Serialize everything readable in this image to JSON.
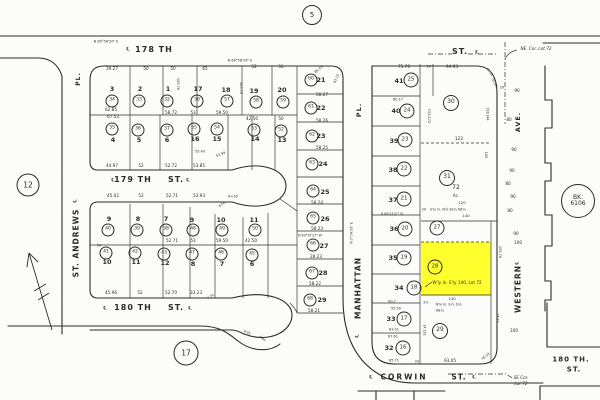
{
  "page": {
    "background": "#fcfcfa",
    "ink": "#2b2b2b",
    "highlight_color": "#ffff2e"
  },
  "highlight": {
    "parcel_circle": "28",
    "x": 421,
    "y": 242,
    "w": 70,
    "h": 53
  },
  "markers": [
    {
      "t": "5",
      "x": 312,
      "y": 15,
      "d": 18,
      "fs": 7
    },
    {
      "t": "12",
      "x": 28,
      "y": 185,
      "d": 21,
      "fs": 7.5
    },
    {
      "t": "17",
      "x": 186,
      "y": 353,
      "d": 23,
      "fs": 7.5
    },
    {
      "t": "BK.\n6106",
      "x": 578,
      "y": 201,
      "d": 32,
      "fs": 6
    }
  ],
  "streets": [
    {
      "t": "178 TH",
      "x": 154,
      "y": 50,
      "fs": 8,
      "ls": 1
    },
    {
      "t": "ST.",
      "x": 460,
      "y": 52,
      "fs": 8
    },
    {
      "t": "179 TH",
      "x": 133,
      "y": 180,
      "fs": 8,
      "ls": 1
    },
    {
      "t": "ST.",
      "x": 176,
      "y": 180,
      "fs": 8
    },
    {
      "t": "180 TH",
      "x": 133,
      "y": 308,
      "fs": 8,
      "ls": 1
    },
    {
      "t": "ST.",
      "x": 176,
      "y": 308,
      "fs": 8
    },
    {
      "t": "CORWIN",
      "x": 404,
      "y": 377,
      "fs": 7.5,
      "ls": 2
    },
    {
      "t": "ST.",
      "x": 459,
      "y": 377,
      "fs": 7.5
    },
    {
      "t": "ST. ANDREWS",
      "x": 76,
      "y": 243,
      "fs": 7.5,
      "r": -90,
      "ls": 1
    },
    {
      "t": "PL.",
      "x": 79,
      "y": 79,
      "fs": 6,
      "r": -90
    },
    {
      "t": "MANHATTAN",
      "x": 358,
      "y": 288,
      "fs": 7.5,
      "r": -90,
      "ls": 1
    },
    {
      "t": "PL.",
      "x": 359,
      "y": 110,
      "fs": 6.5,
      "r": -90
    },
    {
      "t": "WESTERN",
      "x": 518,
      "y": 289,
      "fs": 7.5,
      "r": -90,
      "ls": 1
    },
    {
      "t": "AVE.",
      "x": 518,
      "y": 122,
      "fs": 6.5,
      "r": -90
    },
    {
      "t": "180 TH.",
      "x": 571,
      "y": 360,
      "fs": 7
    },
    {
      "t": "ST.",
      "x": 574,
      "y": 370,
      "fs": 7
    }
  ],
  "centerline_marks": [
    {
      "t": "℄",
      "x": 128,
      "y": 50
    },
    {
      "t": "℄",
      "x": 477,
      "y": 53
    },
    {
      "t": "℄",
      "x": 113,
      "y": 181
    },
    {
      "t": "℄",
      "x": 188,
      "y": 181
    },
    {
      "t": "℄",
      "x": 105,
      "y": 309
    },
    {
      "t": "℄",
      "x": 190,
      "y": 309
    },
    {
      "t": "℄",
      "x": 371,
      "y": 378
    },
    {
      "t": "℄",
      "x": 474,
      "y": 378
    },
    {
      "t": "℄",
      "x": 76,
      "y": 201,
      "r": -90
    },
    {
      "t": "℄",
      "x": 518,
      "y": 263,
      "r": -90
    },
    {
      "t": "℄",
      "x": 358,
      "y": 336,
      "r": -90
    }
  ],
  "notes": [
    {
      "t": "NE. Cor. Lot 72",
      "x": 536,
      "y": 49
    },
    {
      "t": "SE Cor.",
      "x": 521,
      "y": 378
    },
    {
      "t": "Lot 72",
      "x": 521,
      "y": 384
    }
  ],
  "lot_numbers": [
    {
      "t": "3",
      "x": 112,
      "y": 89
    },
    {
      "t": "2",
      "x": 140,
      "y": 89
    },
    {
      "t": "1",
      "x": 168,
      "y": 89
    },
    {
      "t": "17",
      "x": 198,
      "y": 89
    },
    {
      "t": "18",
      "x": 226,
      "y": 90
    },
    {
      "t": "19",
      "x": 254,
      "y": 91
    },
    {
      "t": "20",
      "x": 282,
      "y": 90
    },
    {
      "t": "21",
      "x": 321,
      "y": 80
    },
    {
      "t": "22",
      "x": 321,
      "y": 108
    },
    {
      "t": "23",
      "x": 321,
      "y": 136
    },
    {
      "t": "24",
      "x": 323,
      "y": 164
    },
    {
      "t": "25",
      "x": 325,
      "y": 192
    },
    {
      "t": "26",
      "x": 325,
      "y": 219
    },
    {
      "t": "27",
      "x": 324,
      "y": 246
    },
    {
      "t": "28",
      "x": 323,
      "y": 273
    },
    {
      "t": "29",
      "x": 322,
      "y": 300
    },
    {
      "t": "4",
      "x": 113,
      "y": 140
    },
    {
      "t": "5",
      "x": 139,
      "y": 140
    },
    {
      "t": "6",
      "x": 167,
      "y": 140
    },
    {
      "t": "16",
      "x": 195,
      "y": 139
    },
    {
      "t": "15",
      "x": 217,
      "y": 139
    },
    {
      "t": "14",
      "x": 255,
      "y": 139
    },
    {
      "t": "13",
      "x": 282,
      "y": 140
    },
    {
      "t": "9",
      "x": 109,
      "y": 219
    },
    {
      "t": "8",
      "x": 138,
      "y": 219
    },
    {
      "t": "7",
      "x": 166,
      "y": 219
    },
    {
      "t": "9",
      "x": 192,
      "y": 220
    },
    {
      "t": "10",
      "x": 221,
      "y": 220
    },
    {
      "t": "11",
      "x": 254,
      "y": 220
    },
    {
      "t": "10",
      "x": 107,
      "y": 262
    },
    {
      "t": "11",
      "x": 136,
      "y": 262
    },
    {
      "t": "12",
      "x": 165,
      "y": 263
    },
    {
      "t": "8",
      "x": 193,
      "y": 264
    },
    {
      "t": "7",
      "x": 222,
      "y": 264
    },
    {
      "t": "6",
      "x": 252,
      "y": 264
    },
    {
      "t": "41",
      "x": 399,
      "y": 81
    },
    {
      "t": "40",
      "x": 396,
      "y": 111
    },
    {
      "t": "39",
      "x": 394,
      "y": 141
    },
    {
      "t": "38",
      "x": 393,
      "y": 170
    },
    {
      "t": "37",
      "x": 393,
      "y": 200
    },
    {
      "t": "36",
      "x": 394,
      "y": 229
    },
    {
      "t": "35",
      "x": 393,
      "y": 258
    },
    {
      "t": "34",
      "x": 399,
      "y": 288
    },
    {
      "t": "33",
      "x": 391,
      "y": 319
    },
    {
      "t": "32",
      "x": 389,
      "y": 348
    }
  ],
  "lot_circles": [
    {
      "t": "34",
      "x": 112,
      "y": 101
    },
    {
      "t": "33",
      "x": 139,
      "y": 101
    },
    {
      "t": "32",
      "x": 167,
      "y": 101
    },
    {
      "t": "56",
      "x": 197,
      "y": 101
    },
    {
      "t": "57",
      "x": 227,
      "y": 101
    },
    {
      "t": "58",
      "x": 256,
      "y": 102
    },
    {
      "t": "59",
      "x": 283,
      "y": 102
    },
    {
      "t": "60",
      "x": 311,
      "y": 80
    },
    {
      "t": "61",
      "x": 311,
      "y": 108
    },
    {
      "t": "62",
      "x": 312,
      "y": 136
    },
    {
      "t": "63",
      "x": 312,
      "y": 164
    },
    {
      "t": "64",
      "x": 313,
      "y": 191
    },
    {
      "t": "65",
      "x": 313,
      "y": 218
    },
    {
      "t": "66",
      "x": 313,
      "y": 245
    },
    {
      "t": "67",
      "x": 312,
      "y": 273
    },
    {
      "t": "68",
      "x": 310,
      "y": 300
    },
    {
      "t": "35",
      "x": 112,
      "y": 129
    },
    {
      "t": "36",
      "x": 138,
      "y": 130
    },
    {
      "t": "37",
      "x": 167,
      "y": 130
    },
    {
      "t": "55",
      "x": 194,
      "y": 129
    },
    {
      "t": "54",
      "x": 217,
      "y": 129
    },
    {
      "t": "53",
      "x": 254,
      "y": 130
    },
    {
      "t": "52",
      "x": 281,
      "y": 131
    },
    {
      "t": "40",
      "x": 108,
      "y": 230
    },
    {
      "t": "39",
      "x": 137,
      "y": 230
    },
    {
      "t": "38",
      "x": 166,
      "y": 230
    },
    {
      "t": "48",
      "x": 193,
      "y": 230
    },
    {
      "t": "49",
      "x": 222,
      "y": 230
    },
    {
      "t": "50",
      "x": 255,
      "y": 230
    },
    {
      "t": "41",
      "x": 106,
      "y": 253
    },
    {
      "t": "42",
      "x": 135,
      "y": 253
    },
    {
      "t": "43",
      "x": 164,
      "y": 254
    },
    {
      "t": "47",
      "x": 192,
      "y": 254
    },
    {
      "t": "46",
      "x": 221,
      "y": 254
    },
    {
      "t": "45",
      "x": 252,
      "y": 255
    },
    {
      "t": "25",
      "x": 411,
      "y": 80,
      "d": 13
    },
    {
      "t": "24",
      "x": 407,
      "y": 111,
      "d": 13
    },
    {
      "t": "23",
      "x": 405,
      "y": 140,
      "d": 13
    },
    {
      "t": "22",
      "x": 404,
      "y": 169,
      "d": 13
    },
    {
      "t": "21",
      "x": 404,
      "y": 199,
      "d": 13
    },
    {
      "t": "20",
      "x": 405,
      "y": 229,
      "d": 13
    },
    {
      "t": "19",
      "x": 404,
      "y": 258,
      "d": 13
    },
    {
      "t": "18",
      "x": 414,
      "y": 288,
      "d": 13
    },
    {
      "t": "17",
      "x": 404,
      "y": 319,
      "d": 13
    },
    {
      "t": "16",
      "x": 403,
      "y": 348,
      "d": 13
    },
    {
      "t": "30",
      "x": 451,
      "y": 103,
      "d": 14
    },
    {
      "t": "31",
      "x": 447,
      "y": 178,
      "d": 14
    },
    {
      "t": "27",
      "x": 437,
      "y": 228,
      "d": 13
    },
    {
      "t": "28",
      "x": 435,
      "y": 267,
      "d": 13
    },
    {
      "t": "29",
      "x": 440,
      "y": 331,
      "d": 14
    }
  ],
  "dims": [
    {
      "t": "N 89°58'20\" E",
      "x": 106,
      "y": 42,
      "fs": 3.5
    },
    {
      "t": "N 89°58'20\" E",
      "x": 240,
      "y": 61,
      "fs": 3.5
    },
    {
      "t": "39.27",
      "x": 112,
      "y": 69
    },
    {
      "t": "50",
      "x": 146,
      "y": 69
    },
    {
      "t": "50",
      "x": 173,
      "y": 69
    },
    {
      "t": "65",
      "x": 205,
      "y": 69
    },
    {
      "t": "52",
      "x": 254,
      "y": 67
    },
    {
      "t": "56",
      "x": 281,
      "y": 67
    },
    {
      "t": "65.25",
      "x": 319,
      "y": 70,
      "r": -40,
      "fs": 3.4
    },
    {
      "t": "43.15",
      "x": 337,
      "y": 79,
      "r": -65,
      "fs": 3.4
    },
    {
      "t": "105.76",
      "x": 177,
      "y": 84,
      "r": 90,
      "fs": 3.5
    },
    {
      "t": "105.76",
      "x": 240,
      "y": 88,
      "r": 90,
      "fs": 3.5
    },
    {
      "t": "62.85",
      "x": 111,
      "y": 110
    },
    {
      "t": "67.53",
      "x": 113,
      "y": 117
    },
    {
      "t": "58.72",
      "x": 171,
      "y": 113
    },
    {
      "t": "53",
      "x": 193,
      "y": 113
    },
    {
      "t": "59.50",
      "x": 222,
      "y": 113
    },
    {
      "t": "42.50",
      "x": 252,
      "y": 119
    },
    {
      "t": "50",
      "x": 281,
      "y": 119
    },
    {
      "t": "58.27",
      "x": 322,
      "y": 95
    },
    {
      "t": "58.26",
      "x": 322,
      "y": 121
    },
    {
      "t": "58.25",
      "x": 322,
      "y": 148
    },
    {
      "t": "58.24",
      "x": 317,
      "y": 203
    },
    {
      "t": "58.23",
      "x": 317,
      "y": 229
    },
    {
      "t": "N 89°55'27\" W",
      "x": 310,
      "y": 236,
      "fs": 3.2
    },
    {
      "t": "28.23",
      "x": 316,
      "y": 257
    },
    {
      "t": "58.22",
      "x": 315,
      "y": 284
    },
    {
      "t": "58.21",
      "x": 314,
      "y": 311
    },
    {
      "t": "55.40",
      "x": 200,
      "y": 152,
      "fs": 3.5
    },
    {
      "t": "53.99",
      "x": 221,
      "y": 155,
      "r": -20,
      "fs": 3.4
    },
    {
      "t": "44.97",
      "x": 112,
      "y": 166
    },
    {
      "t": "52",
      "x": 141,
      "y": 166
    },
    {
      "t": "52.72",
      "x": 171,
      "y": 166
    },
    {
      "t": "53.85",
      "x": 199,
      "y": 166
    },
    {
      "t": "45.02",
      "x": 113,
      "y": 196
    },
    {
      "t": "52",
      "x": 141,
      "y": 196
    },
    {
      "t": "52.71",
      "x": 172,
      "y": 196
    },
    {
      "t": "53.93",
      "x": 199,
      "y": 196
    },
    {
      "t": "R=50",
      "x": 233,
      "y": 197,
      "fs": 3.4
    },
    {
      "t": "8.54",
      "x": 222,
      "y": 205,
      "r": -35,
      "fs": 3.2
    },
    {
      "t": "52.71",
      "x": 172,
      "y": 241
    },
    {
      "t": "53",
      "x": 193,
      "y": 241
    },
    {
      "t": "59.50",
      "x": 222,
      "y": 241
    },
    {
      "t": "42.50",
      "x": 251,
      "y": 241
    },
    {
      "t": "50",
      "x": 99,
      "y": 246,
      "fs": 3.5
    },
    {
      "t": "45.96",
      "x": 111,
      "y": 293
    },
    {
      "t": "52",
      "x": 140,
      "y": 293
    },
    {
      "t": "52.70",
      "x": 171,
      "y": 293
    },
    {
      "t": "33.23",
      "x": 196,
      "y": 293
    },
    {
      "t": "7.30",
      "x": 211,
      "y": 297,
      "r": -35,
      "fs": 3.2
    },
    {
      "t": "9.05",
      "x": 247,
      "y": 333,
      "r": 25,
      "fs": 3.2
    },
    {
      "t": "8.84",
      "x": 262,
      "y": 339,
      "r": 40,
      "fs": 3.2
    },
    {
      "t": "N 0°04'33\" E",
      "x": 352,
      "y": 233,
      "r": -90,
      "fs": 3.4
    },
    {
      "t": "75.70",
      "x": 404,
      "y": 67
    },
    {
      "t": "20",
      "x": 429,
      "y": 67,
      "fs": 3.5
    },
    {
      "t": "94.93",
      "x": 452,
      "y": 67
    },
    {
      "t": "45.18",
      "x": 489,
      "y": 72,
      "r": 55,
      "fs": 3.2
    },
    {
      "t": "55.42",
      "x": 494,
      "y": 83,
      "r": 60,
      "fs": 3.2
    },
    {
      "t": "80.17",
      "x": 398,
      "y": 100,
      "fs": 3.5
    },
    {
      "t": "153.272",
      "x": 428,
      "y": 116,
      "r": 90,
      "fs": 3.5
    },
    {
      "t": "128.244",
      "x": 487,
      "y": 114,
      "r": 90,
      "fs": 3.2
    },
    {
      "t": "150",
      "x": 485,
      "y": 155,
      "r": 90,
      "fs": 3.5
    },
    {
      "t": "122",
      "x": 459,
      "y": 139
    },
    {
      "t": "72",
      "x": 456,
      "y": 188,
      "fs": 6
    },
    {
      "t": "Ac.",
      "x": 456,
      "y": 196
    },
    {
      "t": "120",
      "x": 462,
      "y": 203,
      "fs": 3.8
    },
    {
      "t": "20",
      "x": 424,
      "y": 210,
      "fs": 3.5
    },
    {
      "t": "S'ly ln. N½ SE¼ NE¼",
      "x": 448,
      "y": 210,
      "fs": 3.4
    },
    {
      "t": "140",
      "x": 466,
      "y": 216,
      "fs": 3.8
    },
    {
      "t": "155.76",
      "x": 499,
      "y": 252,
      "r": 90,
      "fs": 3.5
    },
    {
      "t": "W'ly ln. E'ly 140, Lot 72",
      "x": 457,
      "y": 283
    },
    {
      "t": "140",
      "x": 452,
      "y": 299,
      "fs": 3.8
    },
    {
      "t": "20.",
      "x": 426,
      "y": 303,
      "fs": 3.5
    },
    {
      "t": "N'ly ln. S½, S½,",
      "x": 449,
      "y": 305,
      "fs": 3.4
    },
    {
      "t": "NE¼",
      "x": 440,
      "y": 311,
      "fs": 3.4
    },
    {
      "t": "90.7",
      "x": 392,
      "y": 302,
      "fs": 3.5
    },
    {
      "t": "55.50",
      "x": 396,
      "y": 309,
      "fs": 3.5
    },
    {
      "t": "83.01",
      "x": 394,
      "y": 330,
      "fs": 3.5
    },
    {
      "t": "67.61",
      "x": 393,
      "y": 337,
      "fs": 3.5
    },
    {
      "t": "N 89°53'27\" W",
      "x": 392,
      "y": 214,
      "fs": 3
    },
    {
      "t": "85.71",
      "x": 394,
      "y": 361,
      "fs": 3.5
    },
    {
      "t": "20",
      "x": 417,
      "y": 362,
      "fs": 3.5
    },
    {
      "t": "93.05",
      "x": 450,
      "y": 361
    },
    {
      "t": "76.03",
      "x": 486,
      "y": 357,
      "r": -40,
      "fs": 3.4
    },
    {
      "t": "16.42",
      "x": 497,
      "y": 318,
      "r": 90,
      "fs": 3.2
    },
    {
      "t": "14.192",
      "x": 424,
      "y": 330,
      "r": 90,
      "fs": 3.2
    },
    {
      "t": "20",
      "x": 502,
      "y": 88,
      "fs": 3.5
    },
    {
      "t": "90",
      "x": 517,
      "y": 91
    },
    {
      "t": "80",
      "x": 509,
      "y": 120
    },
    {
      "t": "90",
      "x": 514,
      "y": 150
    },
    {
      "t": "90",
      "x": 512,
      "y": 171
    },
    {
      "t": "80",
      "x": 508,
      "y": 184
    },
    {
      "t": "90",
      "x": 513,
      "y": 197
    },
    {
      "t": "80",
      "x": 510,
      "y": 211
    },
    {
      "t": "90",
      "x": 516,
      "y": 234
    },
    {
      "t": "100",
      "x": 518,
      "y": 243
    },
    {
      "t": "100",
      "x": 514,
      "y": 331
    }
  ]
}
